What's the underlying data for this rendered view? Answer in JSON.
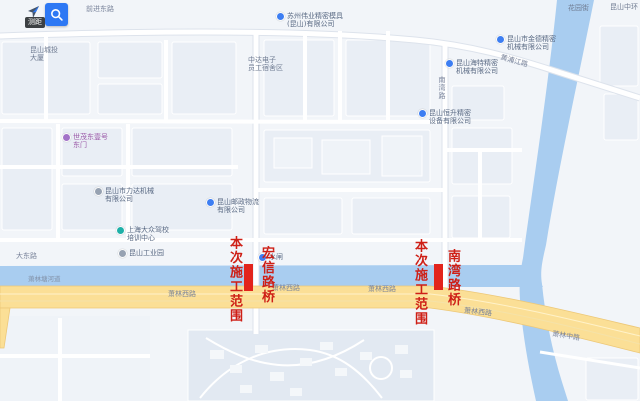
{
  "app": {
    "type": "map-viewer"
  },
  "toolbar": {
    "tooltip": "测距",
    "pan_icon": "navigation-arrow-icon",
    "search_icon": "magnifier-icon",
    "search_button_color": "#2d78f4"
  },
  "construction": {
    "scope_label": "本次施工范围",
    "bridge_left": "宏信路桥",
    "bridge_right": "南湾路桥",
    "highlight_color": "#e2241c",
    "label_color": "#ce1f16"
  },
  "map": {
    "background_color": "#f2f5f9",
    "river_color": "#a9cdf0",
    "arterial_road_color": "#fbdf96",
    "road_labels": [
      {
        "text": "前进东路"
      },
      {
        "text": "黄浦江路"
      },
      {
        "text": "南湾路"
      },
      {
        "text": "大东路"
      },
      {
        "text": "萧林塘河道"
      },
      {
        "text": "萧林西路"
      },
      {
        "text": "萧林西路"
      },
      {
        "text": "萧林西路"
      },
      {
        "text": "萧林西路"
      },
      {
        "text": "萧林中路"
      }
    ],
    "pois": [
      {
        "lines": [
          "昆山城投",
          "大厦"
        ]
      },
      {
        "lines": [
          "世茂东壹号",
          "东门"
        ]
      },
      {
        "lines": [
          "昆山市力达机械",
          "有限公司"
        ]
      },
      {
        "lines": [
          "上海大众驾校",
          "培训中心"
        ]
      },
      {
        "lines": [
          "昆山工业园"
        ]
      },
      {
        "lines": [
          "昆山邮政物流",
          "有限公司"
        ]
      },
      {
        "lines": [
          "水闸"
        ]
      },
      {
        "lines": [
          "苏州伟业精密模具",
          "(昆山)有限公司"
        ]
      },
      {
        "lines": [
          "中达电子",
          "员工宿舍区"
        ]
      },
      {
        "lines": [
          "昆山海特精密",
          "机械有限公司"
        ]
      },
      {
        "lines": [
          "昆山恒升精密",
          "设备有限公司"
        ]
      },
      {
        "lines": [
          "昆山市金德精密",
          "机械有限公司"
        ]
      },
      {
        "lines": [
          "花园街"
        ]
      },
      {
        "lines": [
          "昆山中环"
        ]
      }
    ]
  }
}
